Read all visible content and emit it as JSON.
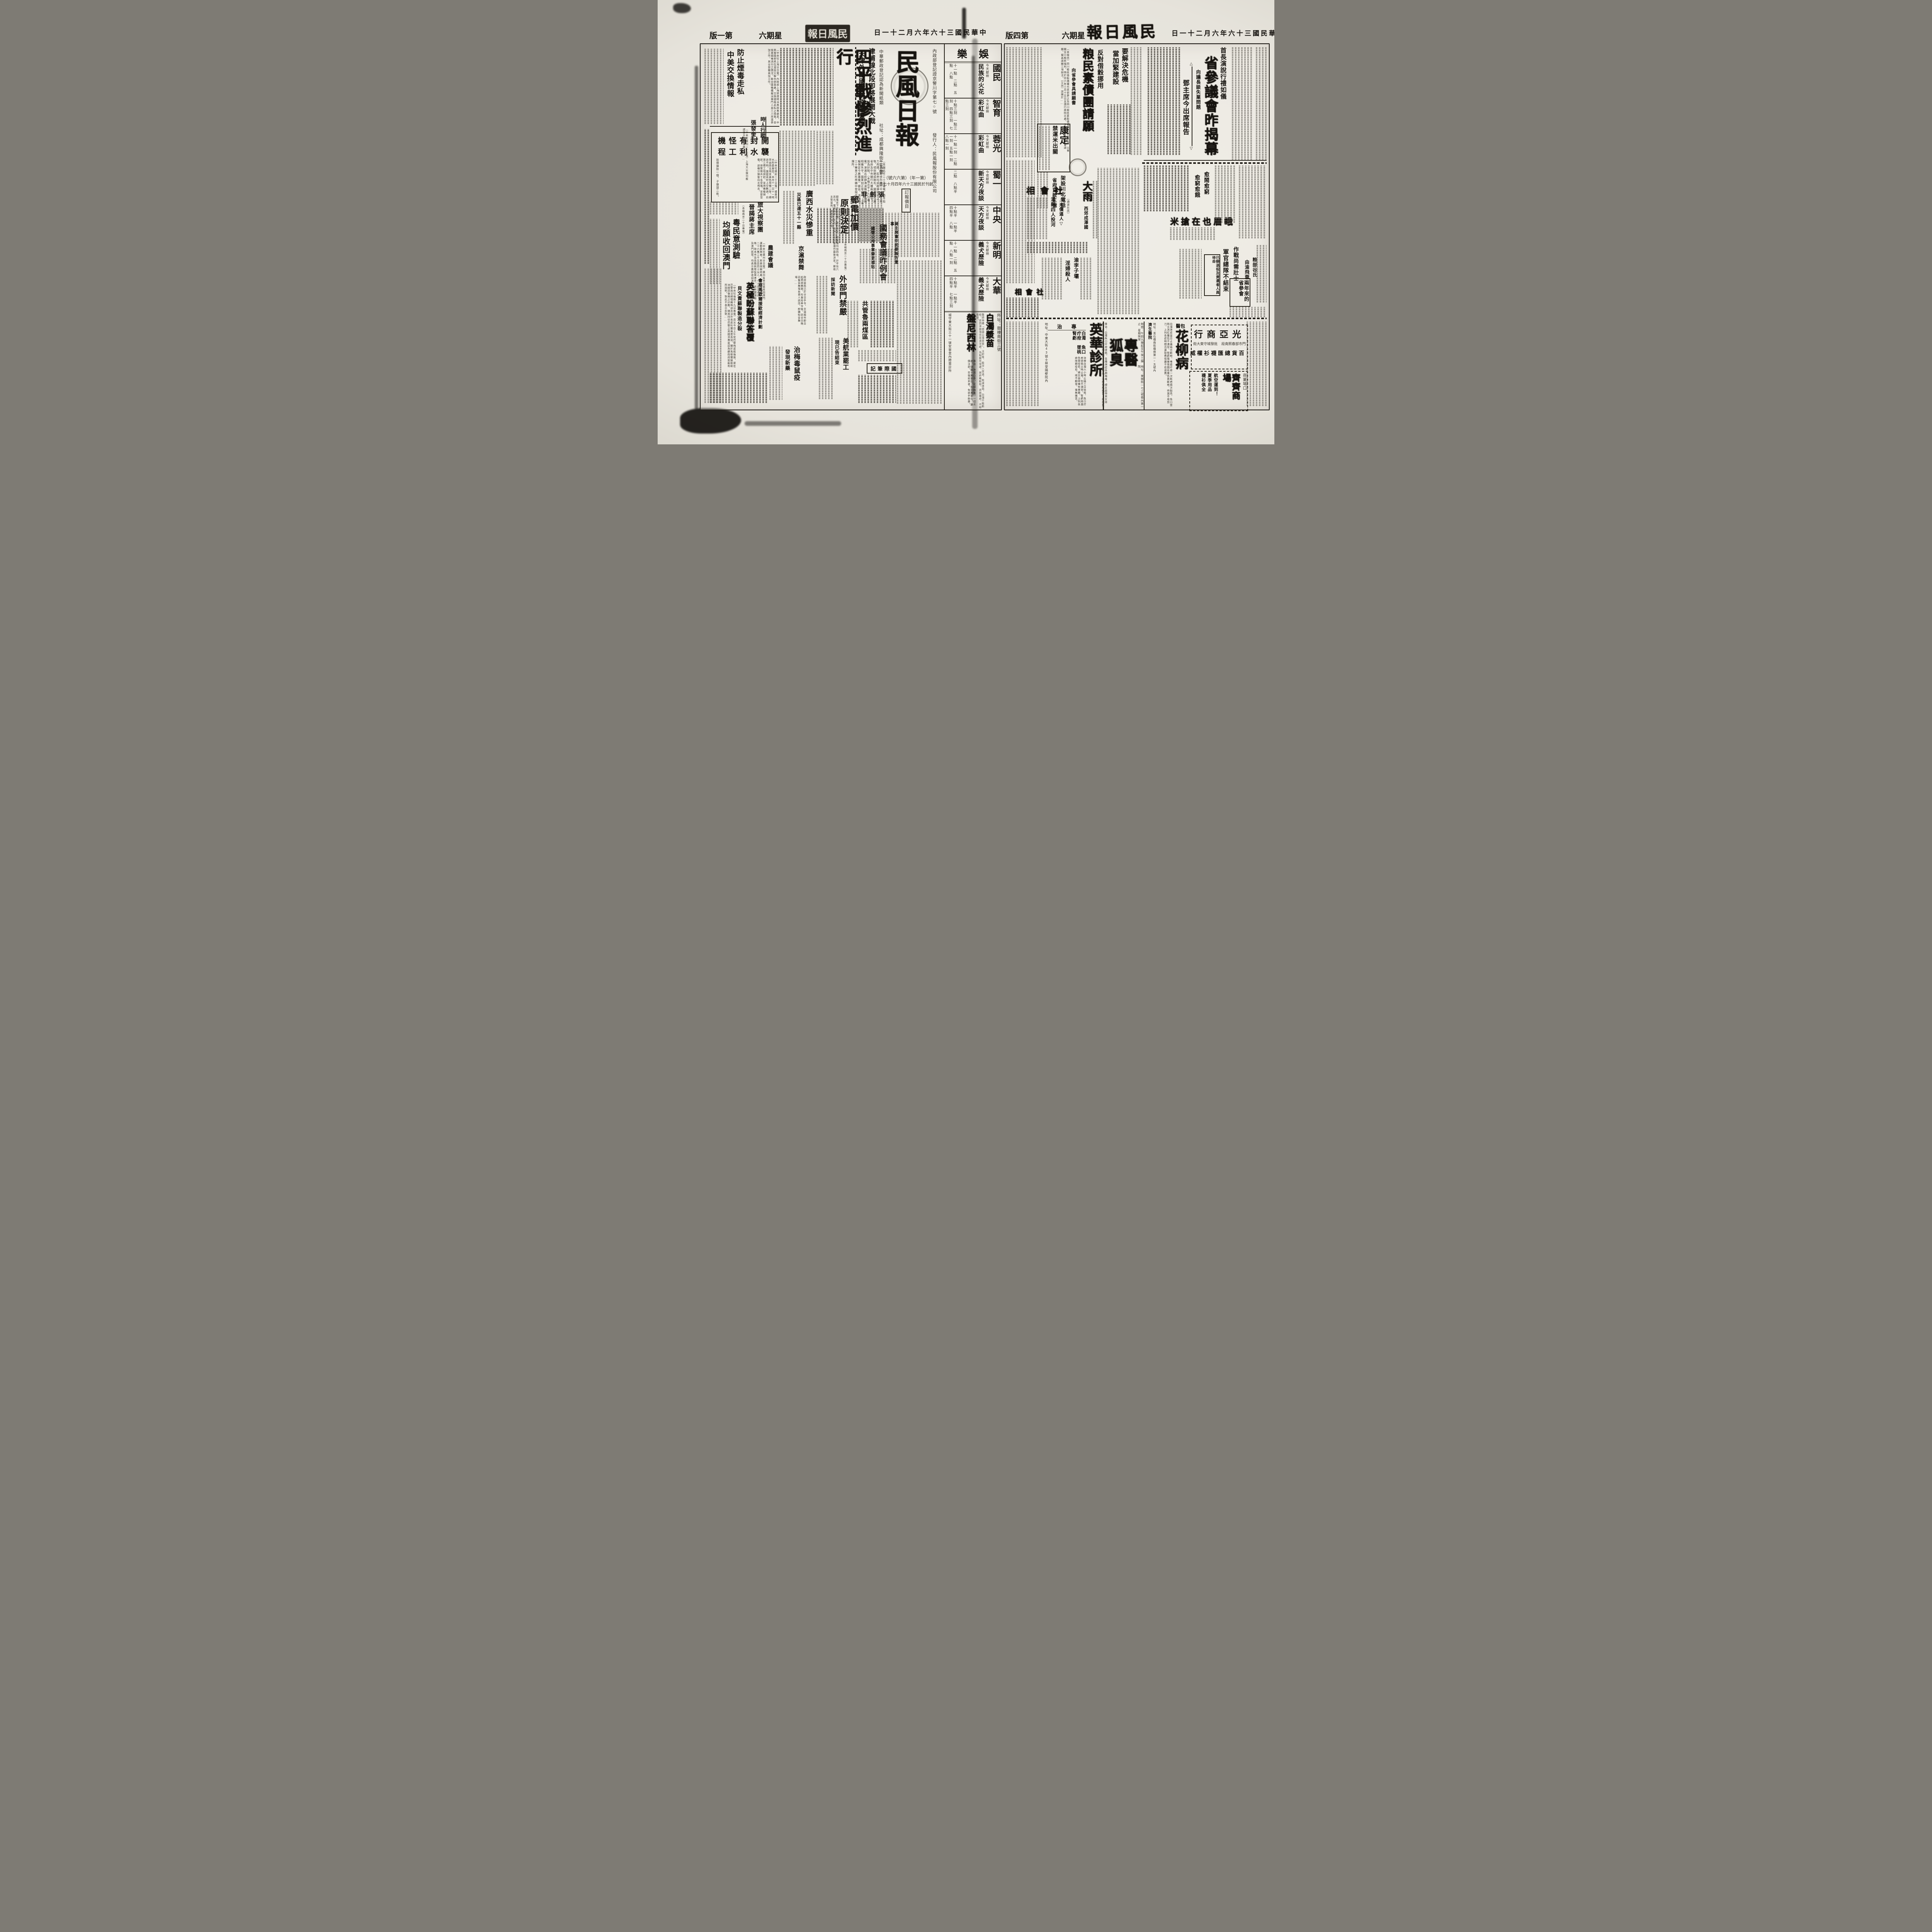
{
  "lp": {
    "header": {
      "edition": "第一版",
      "weekday": "星期六",
      "brand": "民風日報",
      "date": "中華民國三十六年六月二十一日"
    },
    "mast": {
      "title": "民風日報",
      "reg": "內政部登記證京警川字第七○號",
      "pub": "發行人：民風報股份有限公司",
      "postal": "中華郵政登記認為新聞紙類",
      "office": "社址：成都興隆街二五號",
      "issue": "（第一年）（第六六號）",
      "founded": "創刊於民國三十六年四月十七日",
      "price": "訂報價目"
    },
    "lead": {
      "k1": "津浦線北段即將展開大戰",
      "k2": "天津外圍國軍防務極鞏固",
      "hl": "四平戰慘烈進行",
      "body": "（本報北平二十日專電）四平街市區爭奪戰慘烈進行中，雙方死力肉搏，民房均成砲彈摧毀之物，頃刻變成砲灰，國軍刻已將省府及中央銀行大樓兩處據守，設為好點。（本報北平十九日專電）津浦北段靜海滄縣間各據點相繼失守，國軍刻正增援中。（本報保定今晨專電）據息，滄縣西三十華里之杜林鎮中發現共軍指揮所。"
    },
    "drug": {
      "h1": "防止煙毒走私",
      "h2": "中美交換情報",
      "body": "〔中央社上海廿日電〕內政部上海禁煙特派員辦事處息，中美兩國即將在滬設立聯合辦事處，交換烟毒走私之情報，並協查烟毒流行之情況，聯合國機構擬派專門人員三人來滬參加工作，其全部職員加工作。"
    },
    "renwu": {
      "tag": "時人行蹤",
      "person": "張發奎",
      "body": "〔中央社廣州二十日電〕上海大公報刊載謂張主任京專電一則……"
    },
    "kaifeng": {
      "h1": "開封有怪機",
      "h2": "襲水利工程",
      "body": "〔中央社開封二十日電〕據黃河水利委會息，本月十一日十一時突由西北飛來黃色飛機二架，標誌不明，盤旋高村上空數週，向第三標工地掃射，並用機槍掃射，保警隊兵十名受傷，足部受傷，該機分頭後向北飛去。",
      "note": "拾得彈殼一個，子彈頭二枚。"
    },
    "lvda": {
      "l1": "旅大視察團",
      "l2": "晉謁蔣主席",
      "dl": "（本報南京二十日專電）"
    },
    "yue": {
      "h1": "粵民意測驗",
      "h2": "均願收回澳門",
      "body": "〔中央社廣州廿日電〕廣州各界促進收回澳門運動委員會，民意測驗結果，參加投票者一百二十六萬三千五百四十五人，十八日正式公佈，除本市及各縣民眾投票者外，尚有閩湘桂及澳門民眾，均表示應即收回澳門。"
    },
    "nong": {
      "hl": "農建會議"
    },
    "jinghu": {
      "hl": "京滬禁舞",
      "body": "政府當局已於廿日手令，京滬兩市即日起禁絕舞業，社會局奉令後，定廿日晚召集各舞場負責人談話，即轉知各舞場……"
    },
    "guangxi": {
      "hl": "廣西水災慘重",
      "sub": "災區已達五十一縣"
    },
    "zjf": {
      "hl": "張劍非"
    },
    "youdian": {
      "h1": "郵電加價",
      "h2": "原則決定",
      "dl": "（本報南京二十日專電）",
      "body": "郵電定下月起加價，原則決定，郵電價均加四倍，計平信六百元，電報每字一千元，尚待立法院審議作最後決定。郵政主管當局，原要求加九倍。"
    },
    "waibu": {
      "hl": "外部門禁嚴",
      "sub": "採訪新聞"
    },
    "guowu": {
      "k": "蔣主席會中扼要報告重事",
      "hl": "國務會議昨例會",
      "sub": "國營公用事業變更補貼"
    },
    "gongguan": {
      "hl": "共管魯兩煤區"
    },
    "intl": {
      "title": "國際筆記"
    },
    "meihang": {
      "hl": "美航業罷工",
      "sub": "現已告結束"
    },
    "meizhi": {
      "hl": "治梅毒鼠疫",
      "sub": "發現新藥"
    },
    "bevin": {
      "k": "會商馬歇爾援歐經濟計劃",
      "hl": "英極盼蘇聯答覆",
      "sub": "貝文責蘇聯製造分裂",
      "body": "〔中央社倫敦十九日專電〕貝文今日上午從巴黎飛返抵倫敦，渠在巴黎與法總理賴瑪迪及法外長皮杜爾兩度長談，關於馬歇爾援助歐洲經濟復興之計劃，隨其同往巴黎之英經濟專家認為蘇政府如能有所說明，對此不表示反對……"
    },
    "ent": {
      "section": "娛樂",
      "rows": [
        {
          "theater": "國民",
          "note": "今天獻映",
          "film": "民族的火花",
          "times": "十一點　二點　五點　八點"
        },
        {
          "theater": "智育",
          "note": "今天獻映",
          "film": "彩虹曲",
          "times": "十點三刻　一點三刻　四點三刻　七點三刻"
        },
        {
          "theater": "蓉光",
          "note": "今天獻映",
          "film": "彩虹曲",
          "times": "十一點一刻　二點一刻　五點一刻　八點一刻"
        },
        {
          "theater": "蜀一",
          "note": "今夜獻映",
          "film": "新天方夜談",
          "times": "二點　八點半"
        },
        {
          "theater": "中央",
          "note": "今天獻映",
          "film": "天方夜談",
          "times": "十點半　一點半　四點半　八點"
        },
        {
          "theater": "新明",
          "note": "今天獻映",
          "film": "義犬歷險",
          "times": "十一點　二點　五點　八點一刻"
        },
        {
          "theater": "大華",
          "note": "今天獻映",
          "film": "義犬歷險",
          "times": "十點半　一點半　四點半　七點三刻"
        }
      ],
      "ad": {
        "t1": "盤尼西林",
        "t2": "白濁漿苗",
        "intro": "醫師特備「德國白濁漿苗」。注射後，能深入尿道，殺滅淋菌，白濁不能斷根，是因淋菌潛伏尿道深處，為黏膜所保護，故終難斷根，表面雖癒，不時復發。",
        "spec": "專治：淋濁白帶。花柳梅毒。一切炎症。儲藏十萬單位。及廿萬單位。廉價注射。剪報前來者。免收手術費。",
        "addr1": "城守東大街三十一號安寧里內際雲診所",
        "addr2": "所址：鼓樓南街三號"
      }
    }
  },
  "rp": {
    "header": {
      "edition": "第四版",
      "weekday": "星期六",
      "brand": "民風日報",
      "date": "中華民國三十六年六月二十一日"
    },
    "lead": {
      "k": "首長演說行禮如儀",
      "hl": "省參議會昨揭幕",
      "bracket": "向議長談失業問題",
      "sub": "鄧主席今出席報告",
      "up": "△",
      "down": "▽"
    },
    "crisis": {
      "l1": "要解決危機",
      "l2": "當加緊建設"
    },
    "grain": {
      "k": "反對借穀挪用",
      "hl": "粮民素債團請願",
      "sub": "向省參會具請願書",
      "body": "〔本報訊〕四川粮民借穀債權代表郭夢之及四川粮民素穀債權團代表王君等，以事關全川粮民福利，特於卅六年三月十五日呈請行政院示處，今晨赴省參會大會請願，擬具請願三項辦法。〔又訊〕該團於……"
    },
    "kangding": {
      "h1": "康定",
      "h2": "禁運米出關"
    },
    "phone": {
      "hl": "架設川北電話",
      "sub": "省府貸款三億"
    },
    "shehui1": {
      "title": "社會相",
      "i1": "△米價逼人▽",
      "i2": "灌縣四人投河",
      "dl": "〔通波社訊〕"
    },
    "dayu": {
      "hl": "大雨",
      "sub": "西郊成澤國"
    },
    "yinwu": {
      "l1": "渝李子壩",
      "l2": "淫婦殺人"
    },
    "shehui2": {
      "title": "社會相"
    },
    "emei": {
      "s1": "愈鬧愈窮",
      "s2": "愈窮愈餓",
      "hl": "峨眉也在搶米"
    },
    "junguan": {
      "k": "作戰尚需壯士",
      "hl": "軍官總隊不結束",
      "note": "已辦退役及資遣者人員待命"
    },
    "liangbu": {
      "l1": "粮部谷氏",
      "l2": "由渝飛蓉"
    },
    "scanhui": {
      "title": "兩年來的省參會"
    },
    "ads": {
      "yinghua": {
        "name": "英華診所",
        "label": "專治",
        "diseases": "白濁　魚口　疔疳　墜桃　腎虧",
        "body": "治療白濁六小時止痛三日除根，魚口疔疳墜桃立時止痛，包不潰穿，腎虧痔漏負責痊愈，婦女崩帶備有專藥，上列各症限期痊愈，絕不翻發，毫無痛苦。",
        "addr": "地址：中東大街43號士林堂隔壁院內"
      },
      "huchou": {
        "name": "專醫狐臭",
        "hours": "時間：午前九鐘起至午後三鐘止　星期照常",
        "addr": "地址：東御街一七三號巷內第一院",
        "spec": "專治：白濁魚口疔疳墜桃，各種淋症各期梅毒，婦女崩帶男女痔症。本所專治各症概用最新方法最新藥品，治療毫無痛苦，痊愈負責除根。"
      },
      "huajiu": {
        "k": "包醫",
        "name": "花柳病",
        "body": "白濁淋症當日止痛兩日斷根，毒瘡疔疳一次乾疤兩次脫亮，魚口墜桃立消紅腫包不潰穿，腎虧陽痿限期痊應負責斷根，痔漏不用剪刀，上列各症時間迅速取費低廉不愈退費。",
        "addr": "地址：青石橋南街橋側第一○五號內",
        "clinic": "濟生醫院"
      },
      "guangya": {
        "name": "光亞商行",
        "l1": "門市部春熙南段",
        "l2": "批發城守東大街",
        "t1": "百貨總匯",
        "t2": "襪衫權威"
      },
      "qiqi": {
        "loc": "商業場口",
        "name": "齊齊商場",
        "l1": "航空運到！",
        "l2": "夏季用品",
        "l3": "襪衫俱全"
      }
    }
  }
}
